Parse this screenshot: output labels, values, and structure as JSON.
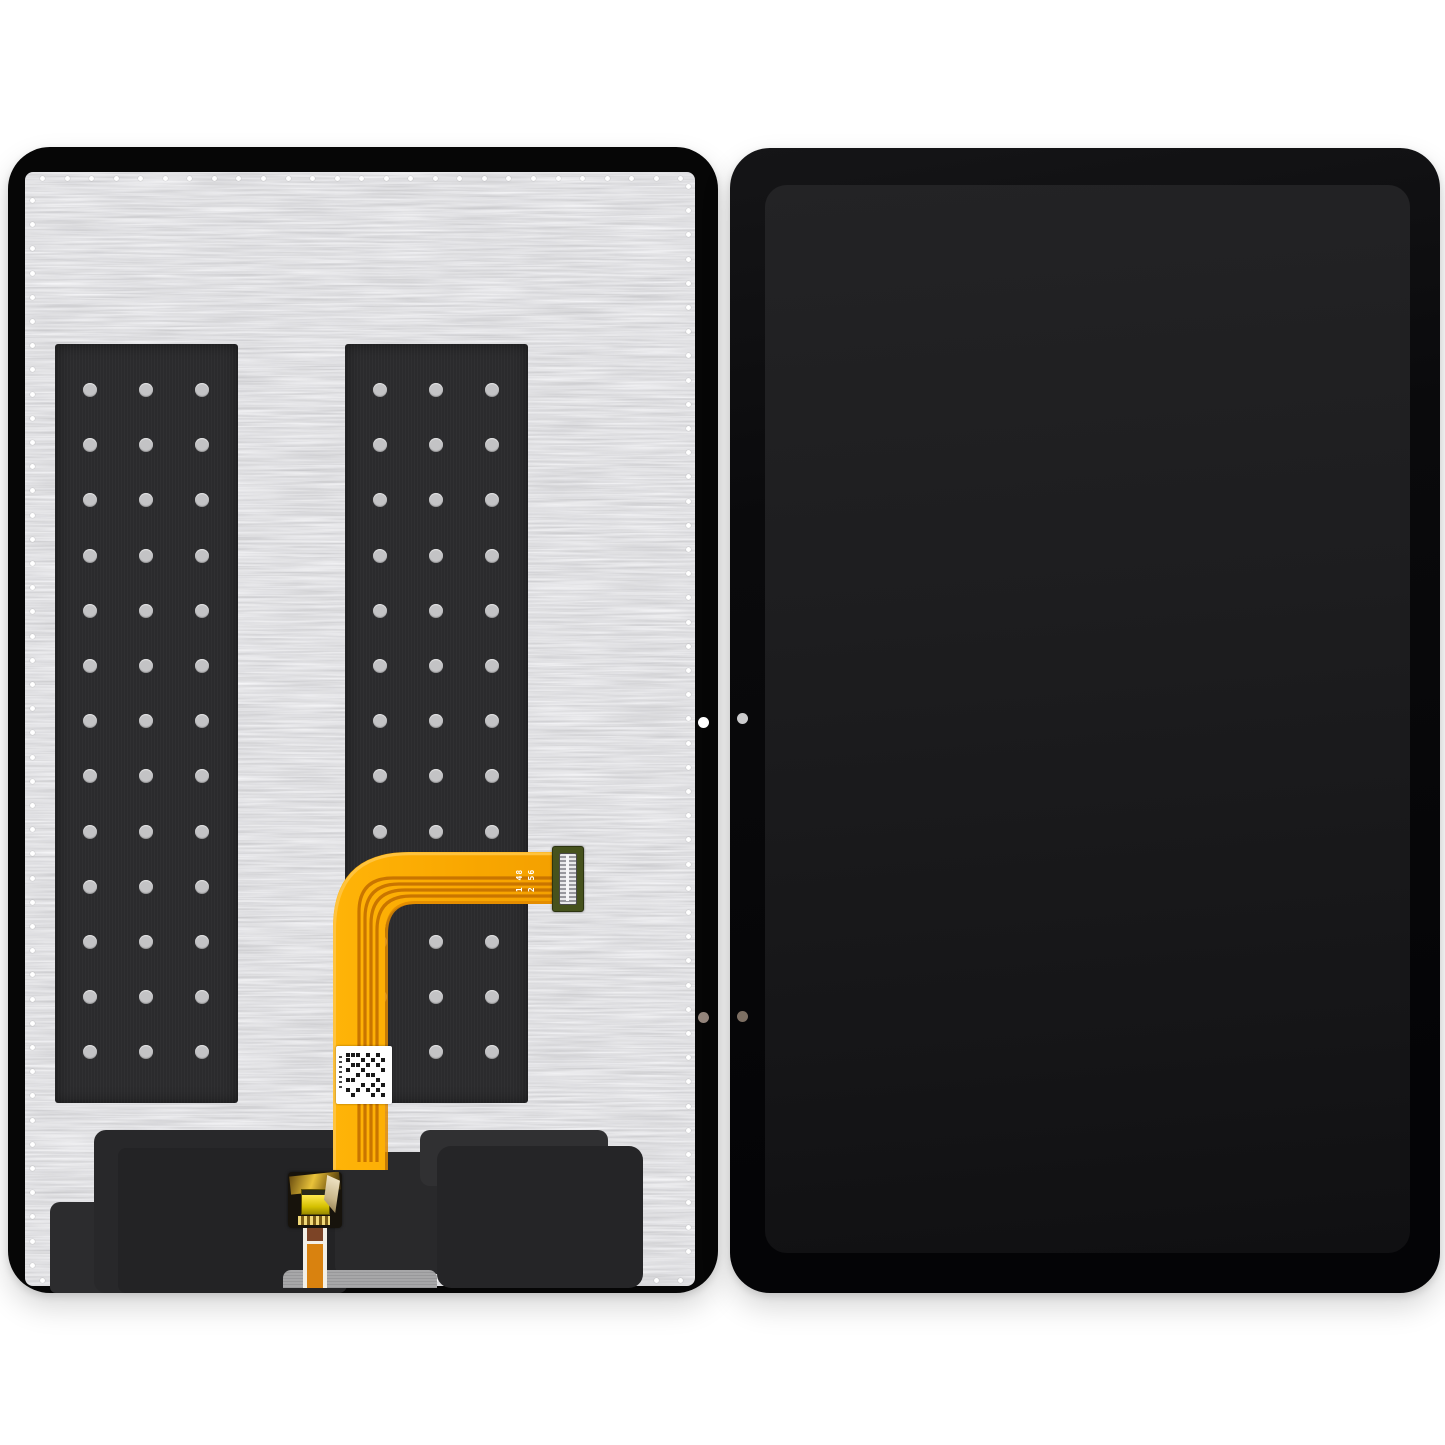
{
  "image": {
    "type": "product-photo",
    "subject": "Tablet LCD display assembly replacement part, back view and front view side by side",
    "background_color": "#ffffff"
  },
  "back_view": {
    "label": "display assembly back side",
    "frame_color": "#060606",
    "plate_color": "#b9b9bb",
    "perimeter_dots": {
      "color": "#ffffff",
      "top_count": 27,
      "bottom_count": 27,
      "left_count": 45,
      "right_count": 45
    },
    "adhesive_strips": {
      "color": "#2b2b2d",
      "rows": 13,
      "cols": 3,
      "hole_color": "#c3c3c5"
    },
    "flex_cable": {
      "color": "#f9a700",
      "trace_color": "#c97500",
      "highlight_color": "#ffc33e",
      "shade_color": "#e08900",
      "marking_line1": "1 48",
      "marking_line2": "2 56",
      "connector_pcb_color": "#46521d",
      "connector_pin_color": "#dcdcde"
    },
    "qr_label": {
      "background": "#ffffff",
      "pattern": "qr-code"
    },
    "board_connector": {
      "gold_color": "#e8c23a",
      "bright_color": "#ffe94f"
    },
    "bottom_ribbon": {
      "stripe_colors": [
        "#f2efe6",
        "#7c4426",
        "#d9820f"
      ]
    },
    "bottom_modules": {
      "color": "#28282a"
    },
    "side_holes": {
      "top_color": "#ffffff",
      "bottom_color": "#94857c"
    }
  },
  "front_view": {
    "label": "display assembly front side",
    "bezel_color": "#0a0a0c",
    "screen_gradient_top": "#232325",
    "screen_gradient_bottom": "#101012",
    "side_holes": {
      "top_color": "#cbcbcd",
      "bottom_color": "#7d6f63"
    }
  }
}
